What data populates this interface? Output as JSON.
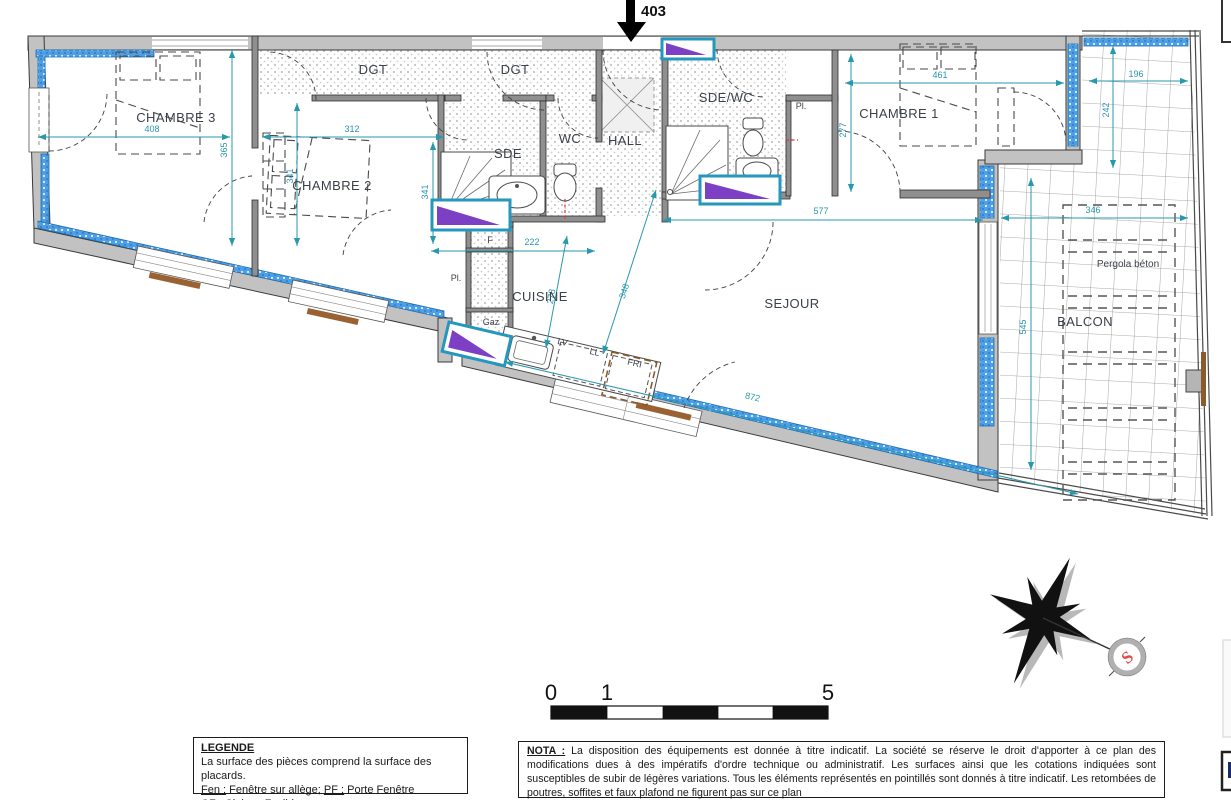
{
  "entrance": {
    "number": "403"
  },
  "rooms": {
    "chambre1": "CHAMBRE 1",
    "chambre2": "CHAMBRE 2",
    "chambre3": "CHAMBRE 3",
    "sejour": "SEJOUR",
    "cuisine": "CUISINE",
    "hall": "HALL",
    "wc": "WC",
    "sde": "SDE",
    "sde_wc": "SDE/WC",
    "dgt_a": "DGT",
    "dgt_b": "DGT",
    "balcon": "BALCON",
    "pergola": "Pergola béton",
    "placard_a": "Pl.",
    "placard_b": "Pl.",
    "f": "F",
    "gaz": "Gaz",
    "lv": "LV",
    "ll": "LL",
    "fri": "FRI"
  },
  "dims": {
    "d408": "408",
    "d365": "365",
    "d312": "312",
    "d341a": "341",
    "d341b": "341",
    "d222": "222",
    "d278": "278",
    "d348": "348",
    "d577": "577",
    "d872": "872",
    "d461": "461",
    "d277": "277",
    "d196": "196",
    "d242": "242",
    "d346": "346",
    "d545": "545"
  },
  "scale_bar": {
    "t0": "0",
    "t1": "1",
    "t5": "5"
  },
  "compass": {
    "south_label": "S"
  },
  "legend": {
    "title": "LEGENDE",
    "line1": "La surface des pièces comprend la surface des placards.",
    "fen_label": "Fen :",
    "fen_value": " Fenêtre sur allège; ",
    "pf_label": "PF :",
    "pf_value": " Porte Fenêtre",
    "cf_label": "CF :",
    "cf_value": " Cloison Fusible"
  },
  "nota": {
    "label": "NOTA :",
    "body": " La disposition des équipements est donnée à titre indicatif. La société se réserve le droit d'apporter à ce plan des modifications dues à des impératifs d'ordre technique ou administratif. Les surfaces ainsi que les cotations indiquées sont susceptibles de subir de légères variations. Tous les éléments représentés en pointillés sont donnés à titre indicatif. Les retombées de poutres, soffites et faux plafond ne figurent pas sur ce plan"
  },
  "colors": {
    "dimension": "#2798ad",
    "window_frame": "#2596be",
    "window_glass": "#4d9fe8",
    "window_accent": "#7d3fc4",
    "wall_fill": "#c2c2c2",
    "sill_wood": "#9a6233",
    "south_letter": "#e04848"
  }
}
